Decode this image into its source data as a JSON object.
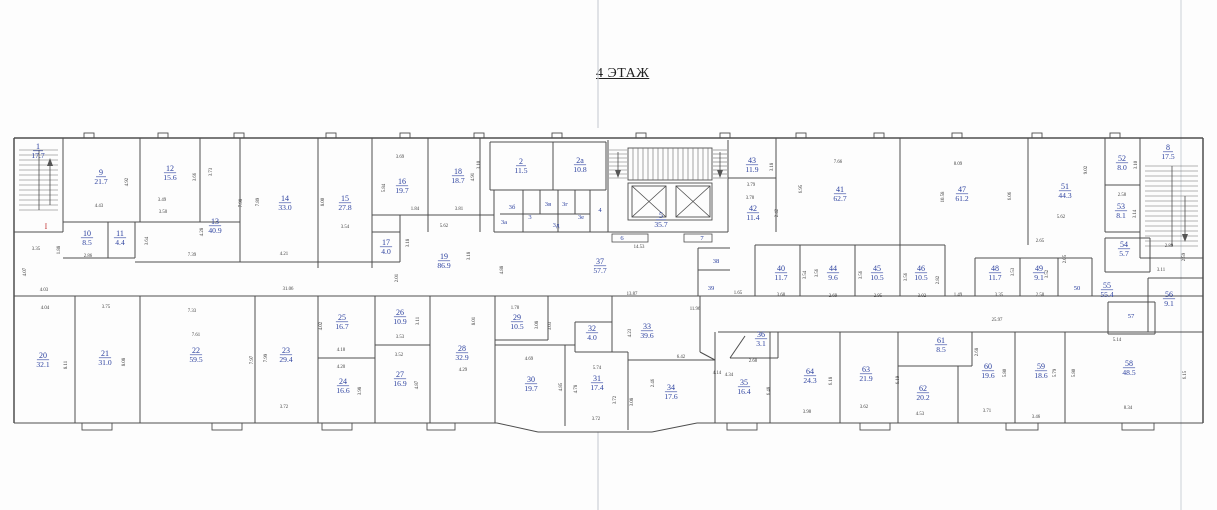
{
  "title": "4 ЭТАЖ",
  "floor_plan": {
    "colors": {
      "room_label": "#2a3f9e",
      "dimension_text": "#3c3c3c",
      "wall": "#4e4e4e",
      "red_mark": "#c43b3b",
      "scan_artifact": "#ccd1d6",
      "paper": "#fdfdfd"
    },
    "rooms": [
      {
        "n": "1",
        "a": "17.7",
        "x": 38,
        "y": 149
      },
      {
        "n": "9",
        "a": "21.7",
        "x": 101,
        "y": 175
      },
      {
        "n": "12",
        "a": "15.6",
        "x": 170,
        "y": 171
      },
      {
        "n": "13",
        "a": "40.9",
        "x": 215,
        "y": 224
      },
      {
        "n": "10",
        "a": "8.5",
        "x": 87,
        "y": 236
      },
      {
        "n": "11",
        "a": "4.4",
        "x": 120,
        "y": 236
      },
      {
        "n": "14",
        "a": "33.0",
        "x": 285,
        "y": 201
      },
      {
        "n": "15",
        "a": "27.8",
        "x": 345,
        "y": 201
      },
      {
        "n": "16",
        "a": "19.7",
        "x": 402,
        "y": 184
      },
      {
        "n": "18",
        "a": "18.7",
        "x": 458,
        "y": 174
      },
      {
        "n": "17",
        "a": "4.0",
        "x": 386,
        "y": 245
      },
      {
        "n": "19",
        "a": "86.9",
        "x": 444,
        "y": 259
      },
      {
        "n": "2",
        "a": "11.5",
        "x": 521,
        "y": 164
      },
      {
        "n": "2а",
        "a": "10.8",
        "x": 580,
        "y": 163
      },
      {
        "n": "3б",
        "x": 512,
        "y": 209,
        "s": 1
      },
      {
        "n": "3в",
        "x": 548,
        "y": 206,
        "s": 1
      },
      {
        "n": "3г",
        "x": 565,
        "y": 206,
        "s": 1
      },
      {
        "n": "3а",
        "x": 504,
        "y": 224,
        "s": 1
      },
      {
        "n": "3",
        "x": 530,
        "y": 219,
        "s": 1
      },
      {
        "n": "3д",
        "x": 556,
        "y": 227,
        "s": 1
      },
      {
        "n": "3е",
        "x": 581,
        "y": 219,
        "s": 1
      },
      {
        "n": "4",
        "x": 600,
        "y": 212,
        "s": 1
      },
      {
        "n": "5",
        "a": "35.7",
        "x": 661,
        "y": 218
      },
      {
        "n": "6",
        "x": 622,
        "y": 240,
        "s": 1
      },
      {
        "n": "7",
        "x": 702,
        "y": 240,
        "s": 1
      },
      {
        "n": "37",
        "a": "57.7",
        "x": 600,
        "y": 264
      },
      {
        "n": "38",
        "x": 716,
        "y": 263,
        "s": 1
      },
      {
        "n": "39",
        "x": 711,
        "y": 290,
        "s": 1
      },
      {
        "n": "43",
        "a": "11.9",
        "x": 752,
        "y": 163
      },
      {
        "n": "42",
        "a": "11.4",
        "x": 753,
        "y": 211
      },
      {
        "n": "41",
        "a": "62.7",
        "x": 840,
        "y": 192
      },
      {
        "n": "47",
        "a": "61.2",
        "x": 962,
        "y": 192
      },
      {
        "n": "51",
        "a": "44.3",
        "x": 1065,
        "y": 189
      },
      {
        "n": "52",
        "a": "8.0",
        "x": 1122,
        "y": 161
      },
      {
        "n": "53",
        "a": "8.1",
        "x": 1121,
        "y": 209
      },
      {
        "n": "8",
        "a": "17.5",
        "x": 1168,
        "y": 150
      },
      {
        "n": "40",
        "a": "11.7",
        "x": 781,
        "y": 271
      },
      {
        "n": "44",
        "a": "9.6",
        "x": 833,
        "y": 271
      },
      {
        "n": "45",
        "a": "10.5",
        "x": 877,
        "y": 271
      },
      {
        "n": "46",
        "a": "10.5",
        "x": 921,
        "y": 271
      },
      {
        "n": "48",
        "a": "11.7",
        "x": 995,
        "y": 271
      },
      {
        "n": "49",
        "a": "9.1",
        "x": 1039,
        "y": 271
      },
      {
        "n": "50",
        "x": 1077,
        "y": 290,
        "s": 1
      },
      {
        "n": "54",
        "a": "5.7",
        "x": 1124,
        "y": 247
      },
      {
        "n": "55",
        "a": "55.4",
        "x": 1107,
        "y": 288
      },
      {
        "n": "56",
        "a": "9.1",
        "x": 1169,
        "y": 297
      },
      {
        "n": "57",
        "x": 1131,
        "y": 318,
        "s": 1
      },
      {
        "n": "20",
        "a": "32.1",
        "x": 43,
        "y": 358
      },
      {
        "n": "21",
        "a": "31.0",
        "x": 105,
        "y": 356
      },
      {
        "n": "22",
        "a": "59.5",
        "x": 196,
        "y": 353
      },
      {
        "n": "23",
        "a": "29.4",
        "x": 286,
        "y": 353
      },
      {
        "n": "25",
        "a": "16.7",
        "x": 342,
        "y": 320
      },
      {
        "n": "26",
        "a": "10.9",
        "x": 400,
        "y": 315
      },
      {
        "n": "24",
        "a": "16.6",
        "x": 343,
        "y": 384
      },
      {
        "n": "27",
        "a": "16.9",
        "x": 400,
        "y": 377
      },
      {
        "n": "28",
        "a": "32.9",
        "x": 462,
        "y": 351
      },
      {
        "n": "29",
        "a": "10.5",
        "x": 517,
        "y": 320
      },
      {
        "n": "32",
        "a": "4.0",
        "x": 592,
        "y": 331
      },
      {
        "n": "33",
        "a": "39.6",
        "x": 647,
        "y": 329
      },
      {
        "n": "30",
        "a": "19.7",
        "x": 531,
        "y": 382
      },
      {
        "n": "31",
        "a": "17.4",
        "x": 597,
        "y": 381
      },
      {
        "n": "34",
        "a": "17.6",
        "x": 671,
        "y": 390
      },
      {
        "n": "36",
        "a": "3.1",
        "x": 761,
        "y": 337
      },
      {
        "n": "35",
        "a": "16.4",
        "x": 744,
        "y": 385
      },
      {
        "n": "64",
        "a": "24.3",
        "x": 810,
        "y": 374
      },
      {
        "n": "63",
        "a": "21.9",
        "x": 866,
        "y": 372
      },
      {
        "n": "61",
        "a": "8.5",
        "x": 941,
        "y": 343
      },
      {
        "n": "62",
        "a": "20.2",
        "x": 923,
        "y": 391
      },
      {
        "n": "60",
        "a": "19.6",
        "x": 988,
        "y": 369
      },
      {
        "n": "59",
        "a": "18.6",
        "x": 1041,
        "y": 369
      },
      {
        "n": "58",
        "a": "48.5",
        "x": 1129,
        "y": 366
      }
    ],
    "dimensions": [
      {
        "t": "3.35",
        "x": 36,
        "y": 250
      },
      {
        "t": "4.07",
        "x": 26,
        "y": 272,
        "v": 1
      },
      {
        "t": "4.43",
        "x": 99,
        "y": 207
      },
      {
        "t": "4.92",
        "x": 128,
        "y": 182,
        "v": 1
      },
      {
        "t": "3.49",
        "x": 162,
        "y": 201
      },
      {
        "t": "3.50",
        "x": 163,
        "y": 213
      },
      {
        "t": "3.66",
        "x": 196,
        "y": 177,
        "v": 1
      },
      {
        "t": "3.73",
        "x": 212,
        "y": 172,
        "v": 1
      },
      {
        "t": "4.28",
        "x": 203,
        "y": 232,
        "v": 1
      },
      {
        "t": "7.39",
        "x": 192,
        "y": 256
      },
      {
        "t": "2.86",
        "x": 88,
        "y": 257
      },
      {
        "t": "1.88",
        "x": 60,
        "y": 250,
        "v": 1
      },
      {
        "t": "3.64",
        "x": 148,
        "y": 241,
        "v": 1
      },
      {
        "t": "4.03",
        "x": 44,
        "y": 291
      },
      {
        "t": "4.04",
        "x": 45,
        "y": 309
      },
      {
        "t": "3.75",
        "x": 106,
        "y": 308
      },
      {
        "t": "7.33",
        "x": 192,
        "y": 312
      },
      {
        "t": "7.61",
        "x": 196,
        "y": 336
      },
      {
        "t": "8.11",
        "x": 67,
        "y": 365,
        "v": 1
      },
      {
        "t": "8.08",
        "x": 125,
        "y": 362,
        "v": 1
      },
      {
        "t": "7.97",
        "x": 253,
        "y": 360,
        "v": 1
      },
      {
        "t": "7.98",
        "x": 242,
        "y": 203,
        "v": 1
      },
      {
        "t": "7.89",
        "x": 259,
        "y": 202,
        "v": 1
      },
      {
        "t": "8.00",
        "x": 324,
        "y": 202,
        "v": 1
      },
      {
        "t": "3.54",
        "x": 345,
        "y": 228
      },
      {
        "t": "4.21",
        "x": 284,
        "y": 255
      },
      {
        "t": "3.69",
        "x": 400,
        "y": 158
      },
      {
        "t": "5.84",
        "x": 385,
        "y": 188,
        "v": 1
      },
      {
        "t": "1.84",
        "x": 415,
        "y": 210
      },
      {
        "t": "3.81",
        "x": 459,
        "y": 210
      },
      {
        "t": "4.91",
        "x": 474,
        "y": 177,
        "v": 1
      },
      {
        "t": "5.62",
        "x": 444,
        "y": 227
      },
      {
        "t": "3.18",
        "x": 409,
        "y": 243,
        "v": 1
      },
      {
        "t": "3.18",
        "x": 470,
        "y": 256,
        "v": 1
      },
      {
        "t": "2.01",
        "x": 398,
        "y": 278,
        "v": 1
      },
      {
        "t": "31.06",
        "x": 288,
        "y": 290
      },
      {
        "t": "3.10",
        "x": 480,
        "y": 165,
        "v": 1
      },
      {
        "t": "14.53",
        "x": 639,
        "y": 248
      },
      {
        "t": "4.88",
        "x": 503,
        "y": 270,
        "v": 1
      },
      {
        "t": "13.87",
        "x": 632,
        "y": 295
      },
      {
        "t": "3.18",
        "x": 773,
        "y": 167,
        "v": 1
      },
      {
        "t": "3.79",
        "x": 751,
        "y": 186
      },
      {
        "t": "3.78",
        "x": 750,
        "y": 199
      },
      {
        "t": "2.42",
        "x": 778,
        "y": 213,
        "v": 1
      },
      {
        "t": "6.95",
        "x": 802,
        "y": 189,
        "v": 1
      },
      {
        "t": "7.66",
        "x": 838,
        "y": 163
      },
      {
        "t": "8.09",
        "x": 958,
        "y": 165
      },
      {
        "t": "10.58",
        "x": 944,
        "y": 197,
        "v": 1
      },
      {
        "t": "3.54",
        "x": 806,
        "y": 275,
        "v": 1
      },
      {
        "t": "3.56",
        "x": 818,
        "y": 273,
        "v": 1
      },
      {
        "t": "3.56",
        "x": 862,
        "y": 275,
        "v": 1
      },
      {
        "t": "3.56",
        "x": 907,
        "y": 277,
        "v": 1
      },
      {
        "t": "2.82",
        "x": 939,
        "y": 280,
        "v": 1
      },
      {
        "t": "1.65",
        "x": 738,
        "y": 294
      },
      {
        "t": "3.68",
        "x": 781,
        "y": 296
      },
      {
        "t": "2.69",
        "x": 833,
        "y": 297
      },
      {
        "t": "2.95",
        "x": 878,
        "y": 297
      },
      {
        "t": "3.02",
        "x": 922,
        "y": 297
      },
      {
        "t": "1.49",
        "x": 958,
        "y": 296
      },
      {
        "t": "6.06",
        "x": 1011,
        "y": 196,
        "v": 1
      },
      {
        "t": "9.02",
        "x": 1087,
        "y": 170,
        "v": 1
      },
      {
        "t": "5.62",
        "x": 1061,
        "y": 218
      },
      {
        "t": "2.58",
        "x": 1122,
        "y": 196
      },
      {
        "t": "3.10",
        "x": 1137,
        "y": 165,
        "v": 1
      },
      {
        "t": "3.14",
        "x": 1136,
        "y": 214,
        "v": 1
      },
      {
        "t": "2.65",
        "x": 1040,
        "y": 242
      },
      {
        "t": "2.05",
        "x": 1066,
        "y": 259,
        "v": 1
      },
      {
        "t": "3.53",
        "x": 1014,
        "y": 272,
        "v": 1
      },
      {
        "t": "3.52",
        "x": 1048,
        "y": 274,
        "v": 1
      },
      {
        "t": "3.35",
        "x": 999,
        "y": 296
      },
      {
        "t": "2.58",
        "x": 1040,
        "y": 296
      },
      {
        "t": "2.89",
        "x": 1169,
        "y": 247
      },
      {
        "t": "2.59",
        "x": 1185,
        "y": 257,
        "v": 1
      },
      {
        "t": "3.11",
        "x": 1161,
        "y": 271
      },
      {
        "t": "5.14",
        "x": 1117,
        "y": 341
      },
      {
        "t": "4.02",
        "x": 322,
        "y": 326,
        "v": 1
      },
      {
        "t": "4.18",
        "x": 341,
        "y": 351
      },
      {
        "t": "4.20",
        "x": 341,
        "y": 368
      },
      {
        "t": "3.53",
        "x": 400,
        "y": 338
      },
      {
        "t": "3.52",
        "x": 399,
        "y": 356
      },
      {
        "t": "3.11",
        "x": 419,
        "y": 321,
        "v": 1
      },
      {
        "t": "7.99",
        "x": 267,
        "y": 358,
        "v": 1
      },
      {
        "t": "8.01",
        "x": 475,
        "y": 321,
        "v": 1
      },
      {
        "t": "4.29",
        "x": 463,
        "y": 371
      },
      {
        "t": "3.72",
        "x": 284,
        "y": 408
      },
      {
        "t": "3.98",
        "x": 361,
        "y": 391,
        "v": 1
      },
      {
        "t": "4.87",
        "x": 418,
        "y": 385,
        "v": 1
      },
      {
        "t": "1.78",
        "x": 515,
        "y": 309
      },
      {
        "t": "3.08",
        "x": 538,
        "y": 325,
        "v": 1
      },
      {
        "t": "3.03",
        "x": 551,
        "y": 326,
        "v": 1
      },
      {
        "t": "4.69",
        "x": 529,
        "y": 360
      },
      {
        "t": "4.23",
        "x": 631,
        "y": 333,
        "v": 1
      },
      {
        "t": "6.42",
        "x": 681,
        "y": 358
      },
      {
        "t": "5.74",
        "x": 597,
        "y": 369
      },
      {
        "t": "4.78",
        "x": 577,
        "y": 389,
        "v": 1
      },
      {
        "t": "4.85",
        "x": 562,
        "y": 387,
        "v": 1
      },
      {
        "t": "3.72",
        "x": 596,
        "y": 420
      },
      {
        "t": "3.72",
        "x": 616,
        "y": 400,
        "v": 1
      },
      {
        "t": "3.08",
        "x": 633,
        "y": 402,
        "v": 1
      },
      {
        "t": "11.96",
        "x": 695,
        "y": 310
      },
      {
        "t": "2.46",
        "x": 654,
        "y": 383,
        "v": 1
      },
      {
        "t": "4.14",
        "x": 717,
        "y": 374
      },
      {
        "t": "2.68",
        "x": 753,
        "y": 362
      },
      {
        "t": "4.34",
        "x": 729,
        "y": 376
      },
      {
        "t": "3.98",
        "x": 807,
        "y": 413
      },
      {
        "t": "3.62",
        "x": 864,
        "y": 408
      },
      {
        "t": "4.53",
        "x": 920,
        "y": 415
      },
      {
        "t": "6.18",
        "x": 832,
        "y": 381,
        "v": 1
      },
      {
        "t": "6.19",
        "x": 899,
        "y": 380,
        "v": 1
      },
      {
        "t": "6.48",
        "x": 770,
        "y": 391,
        "v": 1
      },
      {
        "t": "25.97",
        "x": 997,
        "y": 321
      },
      {
        "t": "2.68",
        "x": 978,
        "y": 352,
        "v": 1
      },
      {
        "t": "5.80",
        "x": 1006,
        "y": 373,
        "v": 1
      },
      {
        "t": "5.79",
        "x": 1056,
        "y": 373,
        "v": 1
      },
      {
        "t": "5.80",
        "x": 1075,
        "y": 373,
        "v": 1
      },
      {
        "t": "3.71",
        "x": 987,
        "y": 412
      },
      {
        "t": "3.46",
        "x": 1036,
        "y": 418
      },
      {
        "t": "8.34",
        "x": 1128,
        "y": 409
      },
      {
        "t": "6.15",
        "x": 1186,
        "y": 375,
        "v": 1
      }
    ],
    "marks": [
      {
        "t": "I",
        "x": 46,
        "y": 229
      }
    ]
  }
}
